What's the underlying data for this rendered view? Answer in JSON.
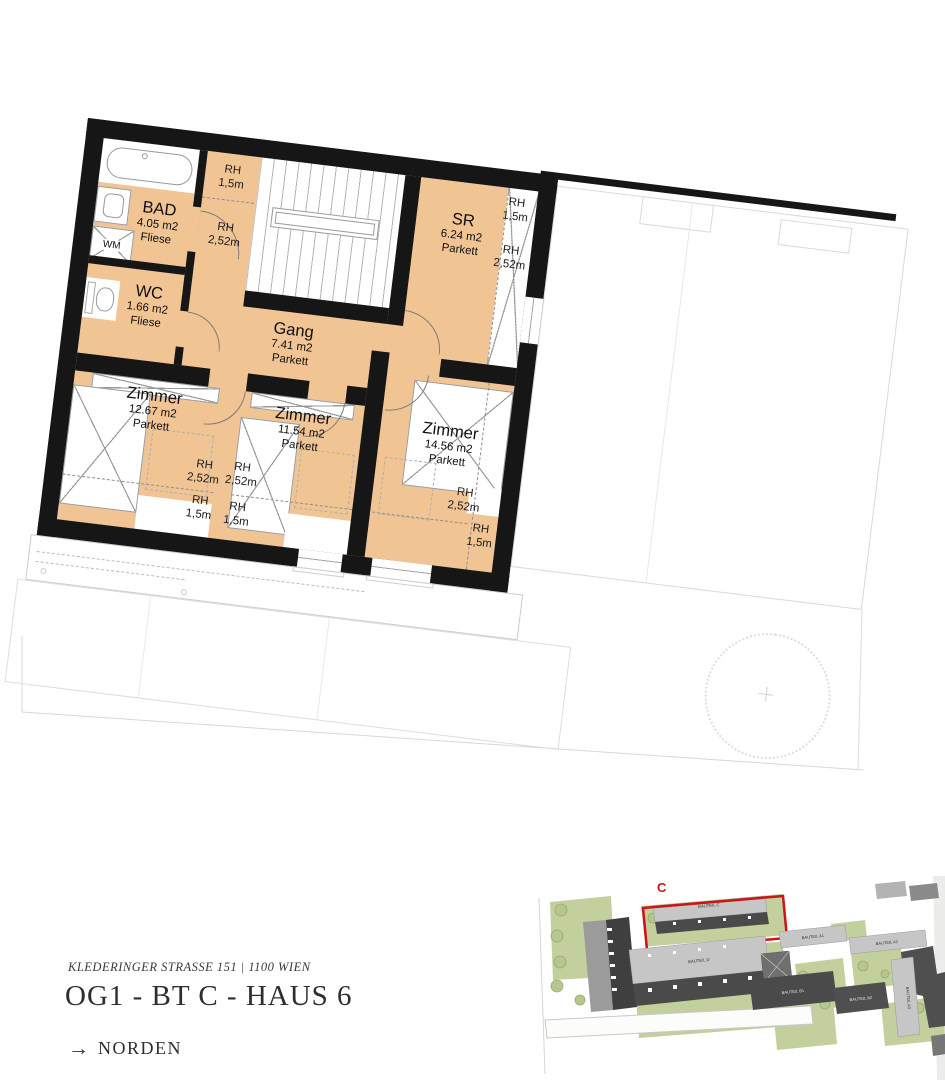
{
  "plan": {
    "rooms": [
      {
        "name": "BAD",
        "area": "4.05 m2",
        "floor": "Fliese"
      },
      {
        "name": "WC",
        "area": "1.66 m2",
        "floor": "Fliese"
      },
      {
        "name": "Gang",
        "area": "7.41 m2",
        "floor": "Parkett"
      },
      {
        "name": "SR",
        "area": "6.24 m2",
        "floor": "Parkett"
      },
      {
        "name": "Zimmer",
        "area": "12.67 m2",
        "floor": "Parkett"
      },
      {
        "name": "Zimmer",
        "area": "11.54 m2",
        "floor": "Parkett"
      },
      {
        "name": "Zimmer",
        "area": "14.56 m2",
        "floor": "Parkett"
      }
    ],
    "rh_label": "RH",
    "rh_values": [
      "1,5m",
      "2,52m",
      "1,5m",
      "2,52m",
      "2,52m",
      "1,5m",
      "2,52m",
      "1,5m",
      "2,52m",
      "1,5m"
    ],
    "wm_label": "WM"
  },
  "footer": {
    "address": "KLEDERINGER STRASSE 151 | 1100 WIEN",
    "title": "OG1 - BT C - HAUS 6",
    "north_arrow": "→",
    "north_label": "NORDEN"
  },
  "site": {
    "highlight": "C",
    "buildings": [
      "BAUTEIL C",
      "BAUTEIL D",
      "BAUTEIL B1",
      "BAUTEIL B2",
      "BAUTEIL A1",
      "BAUTEIL A2",
      "BAUTEIL A3"
    ]
  },
  "colors": {
    "floor": "#f1c493",
    "wall": "#161616",
    "red": "#cc1414",
    "green": "#c3cf9d",
    "tree-fill": "#b6c68c",
    "tree-stroke": "#99aa6e",
    "bldg-light": "#c6c6c6",
    "bldg-dark": "#4a4a4a"
  }
}
